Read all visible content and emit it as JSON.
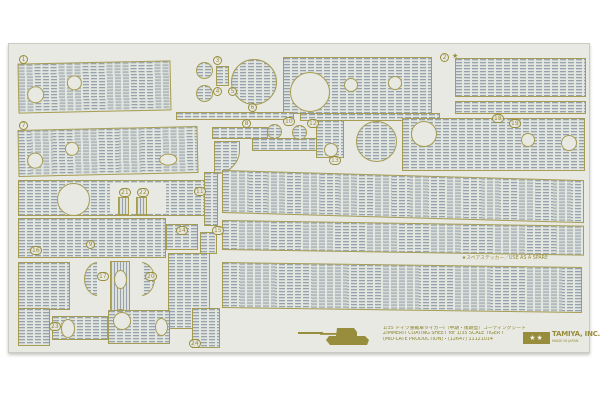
{
  "sheet": {
    "spare_note": "★スペアステッカー／USE AS A SPARE",
    "star": "★",
    "part_numbers": [
      "1",
      "2",
      "3",
      "4",
      "5",
      "6",
      "7",
      "8",
      "10",
      "12",
      "13",
      "18",
      "19",
      "21",
      "22",
      "9",
      "11",
      "14",
      "15",
      "16",
      "17",
      "20",
      "23",
      "24"
    ]
  },
  "footer": {
    "title_jp": "1/35 ドイツ重戦車タイガーI（中期・後期型）コーティングシートセット",
    "title_en": "ZIMMERIT COATING SHEET for 1/35 SCALE TIGER I",
    "code_line": "(MID-LATE PRODUCTION)・(12647) 11121014"
  },
  "brand": {
    "name": "TAMIYA, INC.",
    "sub": "MADE IN JAPAN",
    "stars": "★★"
  },
  "colors": {
    "gold": "#988d3c",
    "texture_line": "#96a2ad",
    "sheet_bg": "#e7e9e2"
  }
}
